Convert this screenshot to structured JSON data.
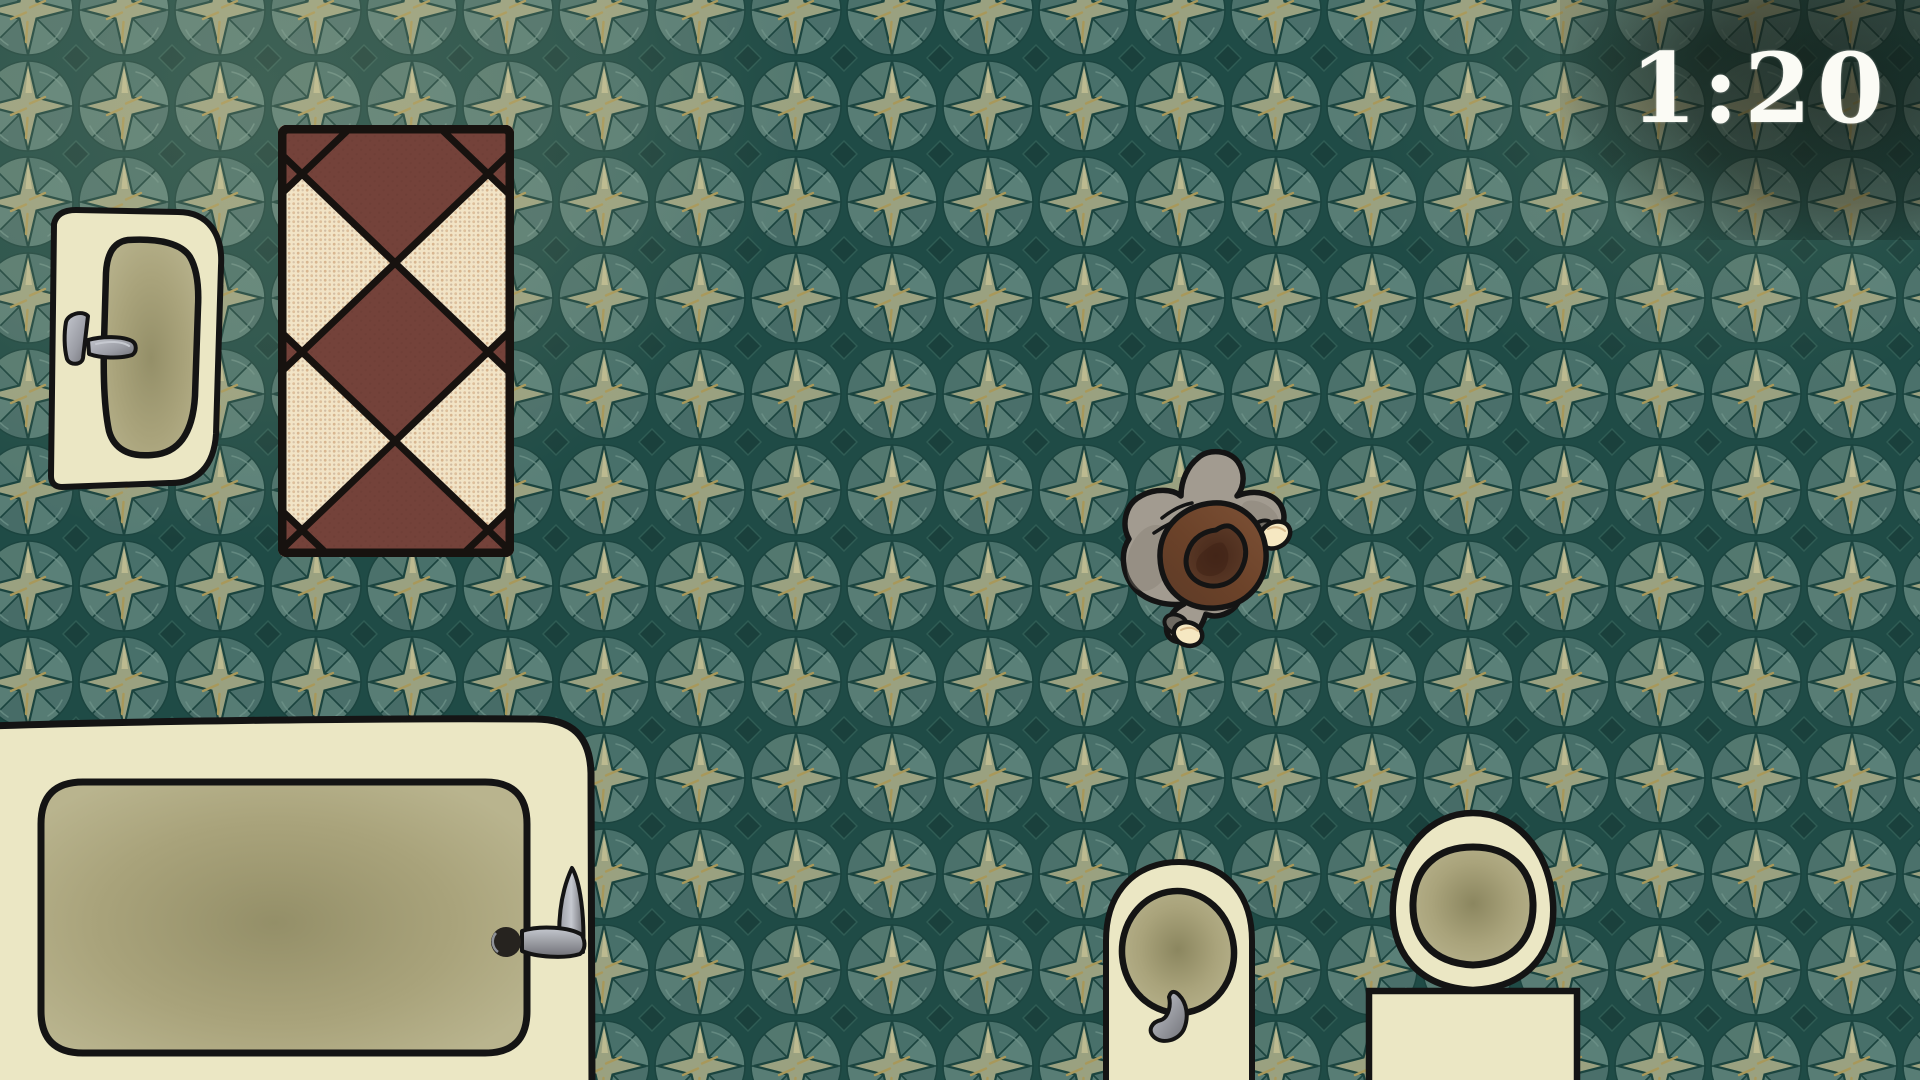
{
  "hud": {
    "timer": {
      "value": "1:20"
    }
  },
  "scene": {
    "view": "top-down-bathroom",
    "entities": [
      "sink",
      "rug",
      "bathtub",
      "bidet",
      "toilet",
      "player-character"
    ]
  },
  "palette": {
    "timer_text": "#fbfbf5",
    "floor_bg": "#1f4b46",
    "floor_line": "#1b443f",
    "floor_q1": "#48706a",
    "floor_q2": "#5a8078",
    "floor_q3": "#4a6f6a",
    "floor_q4": "#567c74",
    "floor_q5": "#476c67",
    "floor_q6": "#587d75",
    "floor_q7": "#4b716b",
    "floor_q8": "#53786f",
    "floor_star": "#9aa180",
    "floor_star_gold": "#a8985a",
    "floor_star_light": "#c2bf93",
    "floor_corner": "#1a403c",
    "floor_corner_edge": "#2f5c54",
    "floor_bevel": "#6f948a",
    "cream": "#ebe7c4",
    "outline": "#141414",
    "basin_edge": "#b9b48e",
    "basin_mid": "#a9a37b",
    "basin_center": "#948f68",
    "basin_deep": "#8b865f",
    "rug_cream": "#f2e4c6",
    "rug_dot": "#cfa67e",
    "rug_dot_dark": "#5e332c",
    "rug_brown": "#74423a",
    "rug_line": "#17120f",
    "metal_light": "#c6c9d0",
    "metal": "#9a9ca4",
    "metal_dark": "#6f7076",
    "coat": "#a29b90",
    "coat_shadow": "#837c72",
    "coat_cuff": "#6f6a62",
    "hat_light": "#7d5136",
    "hat_mid": "#6b4229",
    "hat_dark": "#5c3a27",
    "hat_crown": "#46281a",
    "hand": "#f6e8c2",
    "hand_shade": "#d9bc8e"
  }
}
